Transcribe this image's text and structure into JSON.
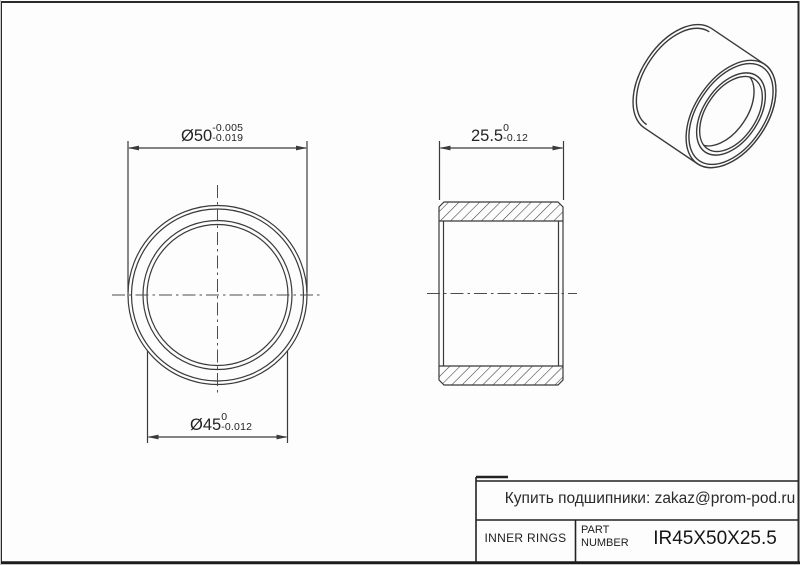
{
  "drawing": {
    "line_color": "#3a3a3a",
    "centerline_color": "#4d4d4d",
    "background": "#fdfdfd"
  },
  "dimensions": {
    "outer_diameter": {
      "value": "Ø50",
      "tol_upper": "-0.005",
      "tol_lower": "-0.019"
    },
    "bore_diameter": {
      "value": "Ø45",
      "tol_upper": "0",
      "tol_lower": "-0.012"
    },
    "width": {
      "value": "25.5",
      "tol_upper": "0",
      "tol_lower": "-0.12"
    }
  },
  "title_block": {
    "contact_line": "Купить подшипники: zakaz@prom-pod.ru",
    "category_label": "INNER RINGS",
    "part_label_line1": "PART",
    "part_label_line2": "NUMBER",
    "part_number_value": "IR45X50X25.5"
  }
}
